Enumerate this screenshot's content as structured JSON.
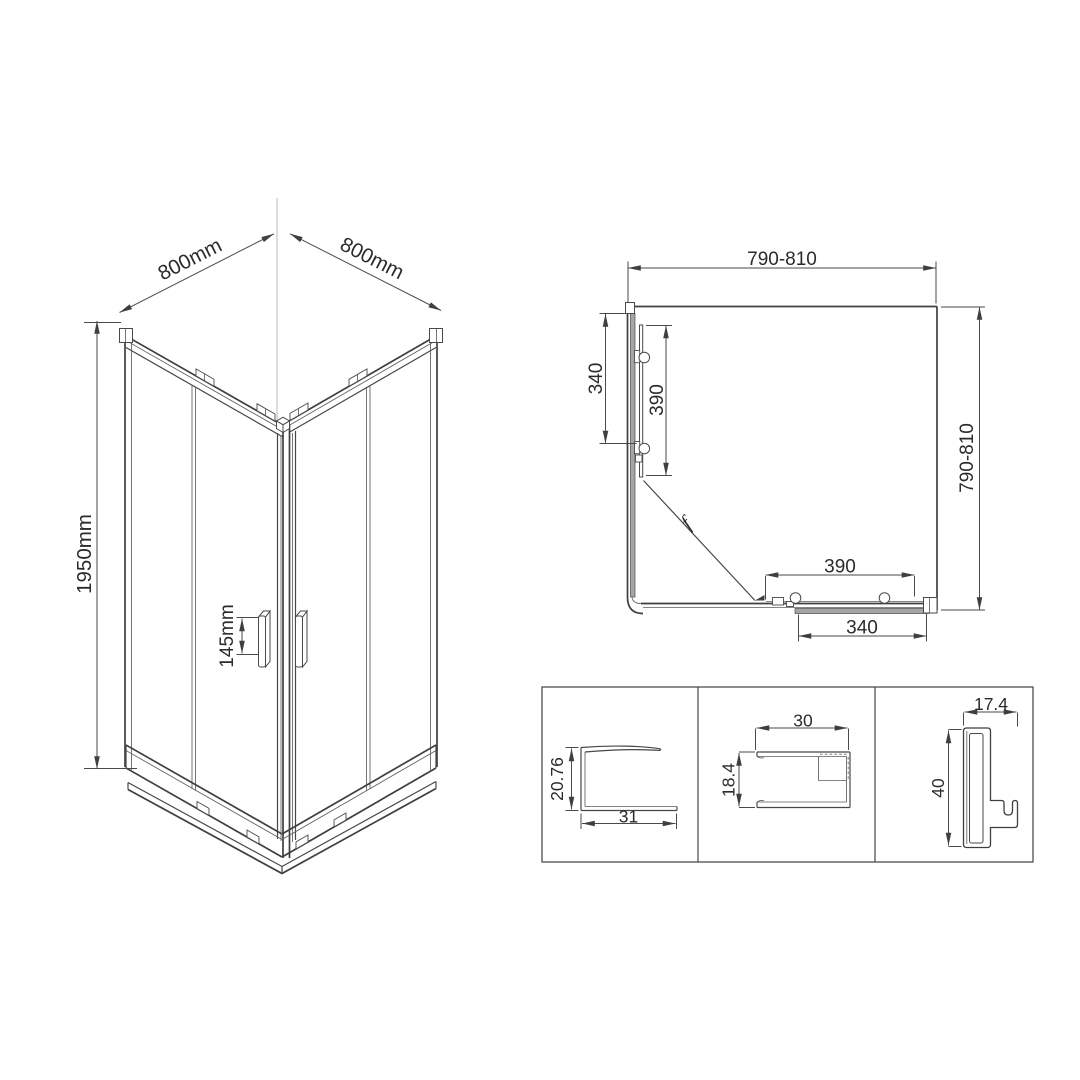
{
  "colors": {
    "background": "#ffffff",
    "line": "#3f3f3f",
    "dim_line": "#4a4a4a",
    "text": "#2b2b2b",
    "glass_fill": "#a5a5a5",
    "construction_line": "#c6c6c6"
  },
  "iso_view": {
    "dim_width_left": "800mm",
    "dim_width_right": "800mm",
    "dim_height": "1950mm",
    "dim_handle": "145mm"
  },
  "plan_view": {
    "dim_width_top": "790-810",
    "dim_depth_right": "790-810",
    "dim_left_outer": "340",
    "dim_left_inner": "390",
    "dim_bottom_inner": "390",
    "dim_bottom_outer": "340",
    "section_mark": "f"
  },
  "profile_details": [
    {
      "dim_height": "20.76",
      "dim_width": "31"
    },
    {
      "dim_width": "30",
      "dim_height": "18.4"
    },
    {
      "dim_width": "17.4",
      "dim_height": "40"
    }
  ]
}
